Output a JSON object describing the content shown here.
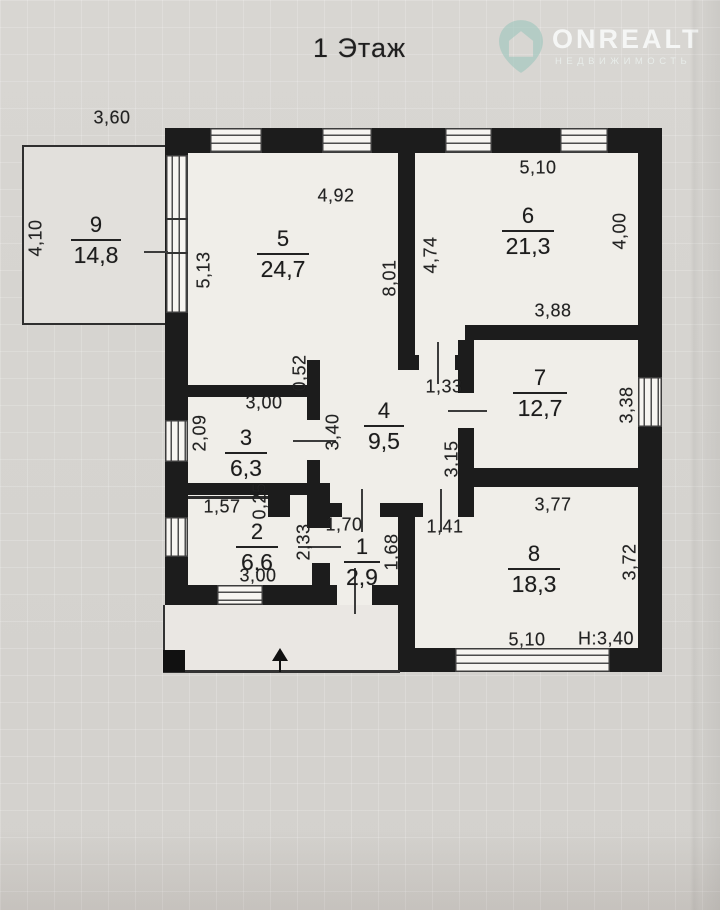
{
  "page": {
    "title": "1 Этаж"
  },
  "watermark": {
    "brand": "ONREALT",
    "tagline": "НЕДВИЖИМОСТЬ",
    "icon": "house-pin-icon",
    "icon_color": "#9ec7bd",
    "text_color": "#f2f5f3"
  },
  "plan": {
    "floor_label": "1 Этаж",
    "ceiling_height": "Н:3,40",
    "rooms": [
      {
        "number": "9",
        "area": "14,8",
        "x": 96,
        "y": 214,
        "line_w": 50
      },
      {
        "number": "5",
        "area": "24,7",
        "x": 283,
        "y": 228,
        "line_w": 52
      },
      {
        "number": "6",
        "area": "21,3",
        "x": 528,
        "y": 205,
        "line_w": 52
      },
      {
        "number": "4",
        "area": "9,5",
        "x": 384,
        "y": 400,
        "line_w": 40
      },
      {
        "number": "7",
        "area": "12,7",
        "x": 540,
        "y": 367,
        "line_w": 54
      },
      {
        "number": "3",
        "area": "6,3",
        "x": 246,
        "y": 427,
        "line_w": 42
      },
      {
        "number": "2",
        "area": "6,6",
        "x": 257,
        "y": 521,
        "line_w": 42
      },
      {
        "number": "1",
        "area": "2,9",
        "x": 362,
        "y": 536,
        "line_w": 36
      },
      {
        "number": "8",
        "area": "18,3",
        "x": 534,
        "y": 543,
        "line_w": 52
      }
    ],
    "dimensions": [
      {
        "text": "3,60",
        "x": 112,
        "y": 118,
        "rot": 0
      },
      {
        "text": "4,10",
        "x": 36,
        "y": 238,
        "rot": 1
      },
      {
        "text": "5,13",
        "x": 204,
        "y": 270,
        "rot": 1
      },
      {
        "text": "4,92",
        "x": 336,
        "y": 196,
        "rot": 0
      },
      {
        "text": "8,01",
        "x": 390,
        "y": 278,
        "rot": 1
      },
      {
        "text": "5,10",
        "x": 538,
        "y": 168,
        "rot": 0
      },
      {
        "text": "4,74",
        "x": 431,
        "y": 255,
        "rot": 1
      },
      {
        "text": "4,00",
        "x": 620,
        "y": 231,
        "rot": 1
      },
      {
        "text": "3,88",
        "x": 553,
        "y": 311,
        "rot": 0
      },
      {
        "text": "1,33",
        "x": 444,
        "y": 387,
        "rot": 0
      },
      {
        "text": "0,52",
        "x": 300,
        "y": 373,
        "rot": 1
      },
      {
        "text": "3,00",
        "x": 264,
        "y": 403,
        "rot": 0
      },
      {
        "text": "2,09",
        "x": 200,
        "y": 433,
        "rot": 1
      },
      {
        "text": "3,40",
        "x": 333,
        "y": 432,
        "rot": 1
      },
      {
        "text": "3,38",
        "x": 627,
        "y": 405,
        "rot": 1
      },
      {
        "text": "3,15",
        "x": 452,
        "y": 459,
        "rot": 1
      },
      {
        "text": "1,57",
        "x": 222,
        "y": 507,
        "rot": 0
      },
      {
        "text": "0,25",
        "x": 260,
        "y": 501,
        "rot": 1
      },
      {
        "text": "2,33",
        "x": 304,
        "y": 542,
        "rot": 1
      },
      {
        "text": "1,70",
        "x": 344,
        "y": 525,
        "rot": 0
      },
      {
        "text": "1,68",
        "x": 392,
        "y": 552,
        "rot": 1
      },
      {
        "text": "1,41",
        "x": 445,
        "y": 527,
        "rot": 0
      },
      {
        "text": "3,77",
        "x": 553,
        "y": 505,
        "rot": 0
      },
      {
        "text": "3,72",
        "x": 630,
        "y": 562,
        "rot": 1
      },
      {
        "text": "3,00",
        "x": 258,
        "y": 576,
        "rot": 0
      },
      {
        "text": "5,10",
        "x": 527,
        "y": 640,
        "rot": 0
      }
    ]
  }
}
